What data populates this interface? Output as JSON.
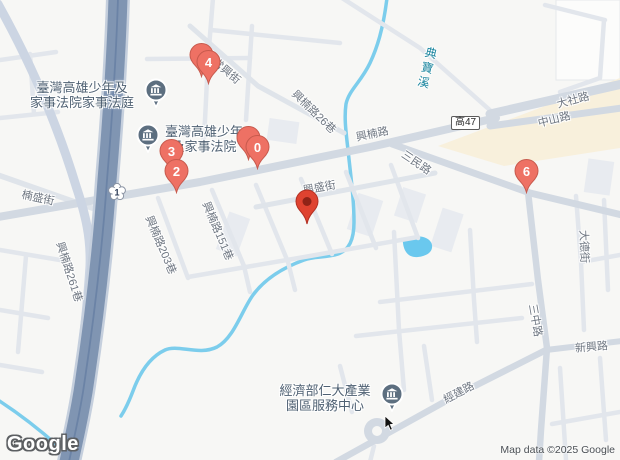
{
  "attribution": "Map data ©2025 Google",
  "logo": "Google",
  "shields": {
    "county_route_47": "高47",
    "national_highway_1": "1"
  },
  "markers": {
    "marker_4": "4",
    "marker_0": "0",
    "marker_3": "3",
    "marker_2": "2",
    "marker_6": "6"
  },
  "pois": {
    "family_court_annex": {
      "line1": "臺灣高雄少年及",
      "line2": "家事法院家事法庭"
    },
    "family_court": {
      "line1": "臺灣高雄少年",
      "line2": "及家事法院"
    },
    "industry_service_center": {
      "line1": "經濟部仁大產業",
      "line2": "園區服務中心"
    }
  },
  "roads": {
    "changxing_st": "常興街",
    "xingnan_rd": "興楠路",
    "xingnan_ln26": "興楠路26巷",
    "xingnan_ln151": "興楠路151巷",
    "xingnan_ln203": "興楠路203巷",
    "xingnan_ln261": "興楠路261巷",
    "nansheng_st": "楠盛街",
    "xingsheng_st": "興盛街",
    "dashe_rd": "大社路",
    "zhongshan_rd": "中山路",
    "sanmin_rd": "三民路",
    "sanzhong_rd": "三中路",
    "dade_st": "大德街",
    "xinxing_rd": "新興路",
    "jingjian_rd": "經建路"
  },
  "water": {
    "dianbao_creek": "典寶溪"
  },
  "icons": {
    "poi": "government-building-icon",
    "marker": "map-pin-icon",
    "cursor": "mouse-cursor-icon"
  },
  "colors": {
    "background": "#f7f7f5",
    "marker_fill": "#ee7164",
    "marker_border": "#c75a4d",
    "pin_fill": "#df4330",
    "pin_center": "#8f2317",
    "freeway": "#8095b2",
    "major_road": "#d2d9e2",
    "water": "#7ccdec",
    "commercial_area": "#f8f0dc",
    "poi_icon": "#5d6f80"
  }
}
